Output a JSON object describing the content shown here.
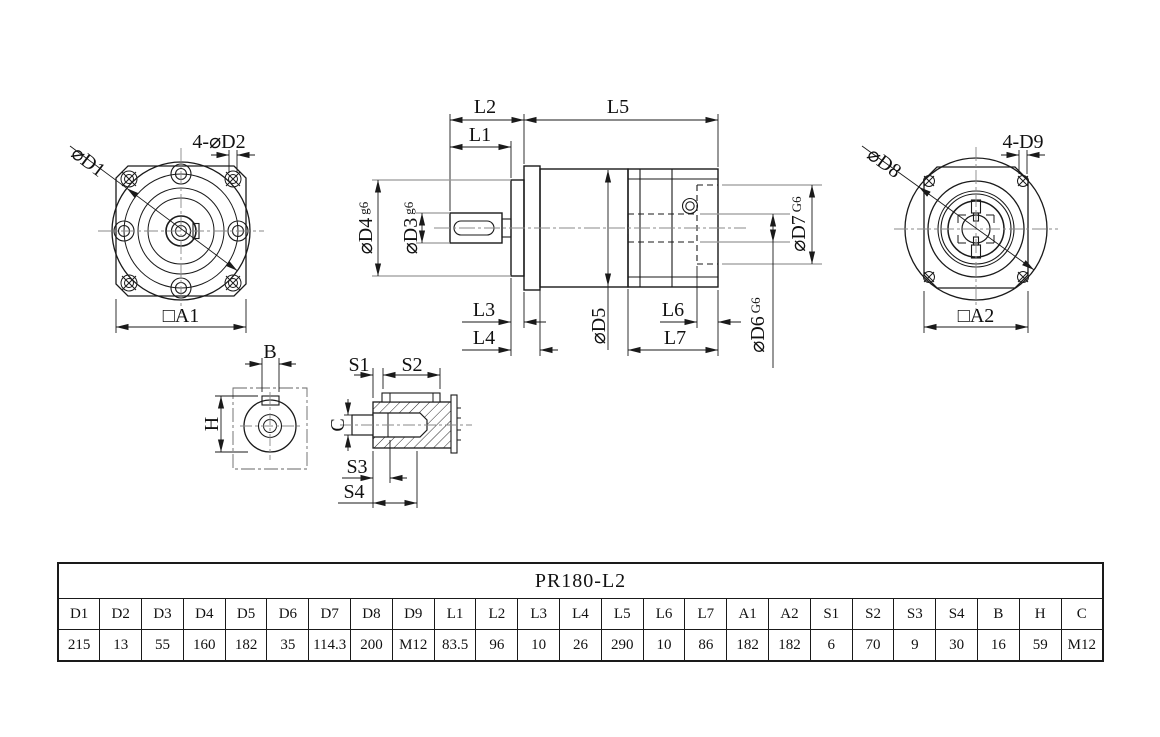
{
  "labels": {
    "d1": "⌀D1",
    "d2_holes": "4-⌀D2",
    "a1": "□A1",
    "d8": "⌀D8",
    "d9_holes": "4-D9",
    "a2": "□A2",
    "l1": "L1",
    "l2": "L2",
    "l5": "L5",
    "l3": "L3",
    "l4": "L4",
    "l6": "L6",
    "l7": "L7",
    "d3": "⌀D3",
    "d3_fit": "g6",
    "d4": "⌀D4",
    "d4_fit": "g6",
    "d5": "⌀D5",
    "d6": "⌀D6",
    "d6_fit": "G6",
    "d7": "⌀D7",
    "d7_fit": "G6",
    "b": "B",
    "h": "H",
    "c": "C",
    "s1": "S1",
    "s2": "S2",
    "s3": "S3",
    "s4": "S4"
  },
  "table": {
    "title": "PR180-L2",
    "headers": [
      "D1",
      "D2",
      "D3",
      "D4",
      "D5",
      "D6",
      "D7",
      "D8",
      "D9",
      "L1",
      "L2",
      "L3",
      "L4",
      "L5",
      "L6",
      "L7",
      "A1",
      "A2",
      "S1",
      "S2",
      "S3",
      "S4",
      "B",
      "H",
      "C"
    ],
    "values": [
      "215",
      "13",
      "55",
      "160",
      "182",
      "35",
      "114.3",
      "200",
      "M12",
      "83.5",
      "96",
      "10",
      "26",
      "290",
      "10",
      "86",
      "182",
      "182",
      "6",
      "70",
      "9",
      "30",
      "16",
      "59",
      "M12"
    ]
  }
}
